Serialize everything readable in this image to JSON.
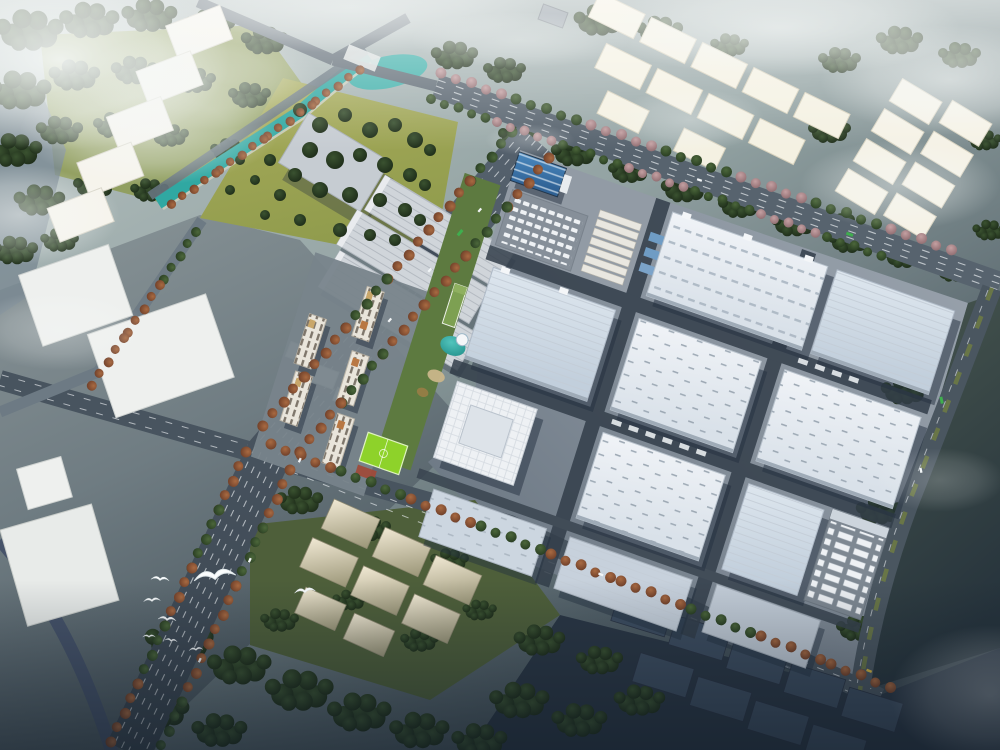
{
  "scene": {
    "title": "Aerial master-plan rendering of an industrial park campus at dusk",
    "type": "architectural-3d-render",
    "regions": {
      "sky": "Hazy sky with white clouds and fog",
      "forest": "Dense dark-green forest belts",
      "river": "River along the western edge",
      "canal": "Teal canal widening into a pond",
      "park": "Olive lawn park with scattered trees",
      "nw_ghosts": "Five future-phase white warehouse blocks, north-west",
      "top_ghosts": "Future-phase white massing blocks, north",
      "ne_ghosts": "Future-phase white massing blocks, north-east",
      "boulevard": "Main diagonal boulevard lined with autumn trees",
      "campus": "Industrial campus of large white and pale-blue warehouses",
      "entrance": "Campus entrance zone with blue gate hall, car park and dormitory rows",
      "amenity": "Amenity strip with pond, white sphere pavilion and green-roofed building",
      "residential": "Mid-rise residential slabs with rooftop boxes",
      "pitch": "Bright green football pitch",
      "truck_yard": "Trailer yard with rows of white trailers",
      "south_ghosts": "Sunlit beige massing blocks among dark woods, south",
      "se_ghosts": "Dark massing blocks in shadow, south-east",
      "birds": "White gulls flying over the boulevard",
      "roads": "Secondary roads with lane markings and green medians"
    },
    "counts": {
      "birds": 8,
      "main_warehouses": 12,
      "residential_towers": 5,
      "nw_ghost_blocks": 5,
      "top_ghost_blocks": 11,
      "ne_ghost_blocks": 8,
      "south_ghost_blocks": 8,
      "se_ghost_blocks": 9
    },
    "palette": {
      "haze": "#f4f7f6",
      "forest": "#26371f",
      "park_lawn": "#a6aa58",
      "canal_teal": "#30a8a2",
      "river_slate": "#7b8a93",
      "road_grey": "#4d5966",
      "campus_pad": "#8b95a0",
      "roof_white": "#eef1f5",
      "roof_blue": "#ccd7e2",
      "ghost_cream": "#f5f3ea",
      "ghost_dark": "#3d4d60",
      "ghost_beige": "#efe7d2",
      "gate_blue": "#3e7fb5",
      "pitch_green": "#8ed22a",
      "autumn_tree": "#8a5138",
      "pink_tree": "#c4a0a2",
      "residential_roof": "#c9a76a",
      "bus_green": "#3fae4e"
    }
  }
}
